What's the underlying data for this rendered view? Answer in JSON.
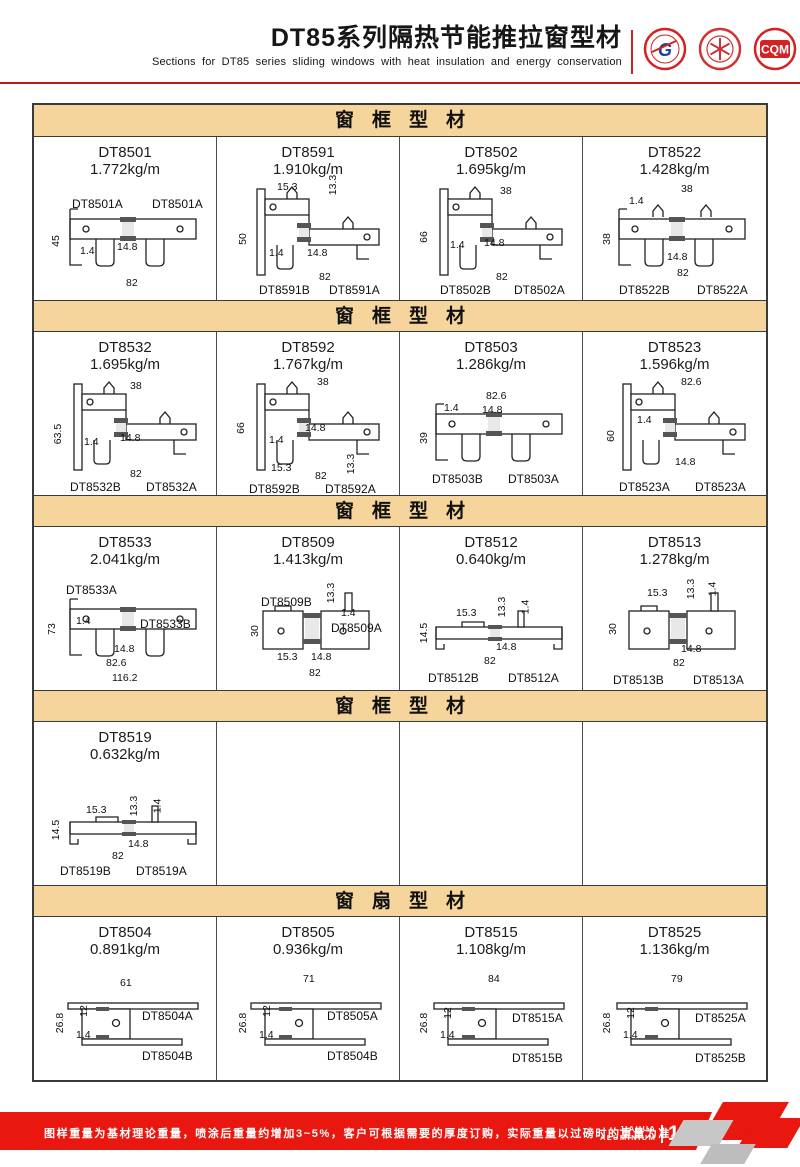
{
  "header": {
    "title": "DT85系列隔热节能推拉窗型材",
    "subtitle": "Sections for DT85 series sliding windows with heat insulation and energy conservation",
    "cqm": "CQM"
  },
  "colors": {
    "accent_red": "#e8170f",
    "rule_red": "#c51718",
    "band_tan": "#f5d59c",
    "line_dark": "#3a3a3a"
  },
  "sections": [
    {
      "title": "窗框型材",
      "cells": [
        {
          "code": "DT8501",
          "weight": "1.772kg/m",
          "shape": "flat",
          "labels": [
            {
              "t": "DT8501A",
              "x": 38,
              "y": 60
            },
            {
              "t": "DT8501A",
              "x": 118,
              "y": 60
            }
          ],
          "dims": [
            {
              "t": "45",
              "x": 16,
              "y": 98,
              "v": true
            },
            {
              "t": "1.4",
              "x": 46,
              "y": 108
            },
            {
              "t": "14.8",
              "x": 83,
              "y": 104
            },
            {
              "t": "82",
              "x": 92,
              "y": 140
            }
          ]
        },
        {
          "code": "DT8591",
          "weight": "1.910kg/m",
          "shape": "step",
          "labels": [
            {
              "t": "DT8591B",
              "x": 42,
              "y": 146
            },
            {
              "t": "DT8591A",
              "x": 112,
              "y": 146
            }
          ],
          "dims": [
            {
              "t": "15.3",
              "x": 60,
              "y": 44
            },
            {
              "t": "13.3",
              "x": 106,
              "y": 42,
              "v": true
            },
            {
              "t": "50",
              "x": 20,
              "y": 96,
              "v": true
            },
            {
              "t": "1.4",
              "x": 52,
              "y": 110
            },
            {
              "t": "14.8",
              "x": 90,
              "y": 110
            },
            {
              "t": "82",
              "x": 102,
              "y": 134
            }
          ]
        },
        {
          "code": "DT8502",
          "weight": "1.695kg/m",
          "shape": "step",
          "labels": [
            {
              "t": "DT8502B",
              "x": 40,
              "y": 146
            },
            {
              "t": "DT8502A",
              "x": 114,
              "y": 146
            }
          ],
          "dims": [
            {
              "t": "38",
              "x": 100,
              "y": 48
            },
            {
              "t": "66",
              "x": 18,
              "y": 94,
              "v": true
            },
            {
              "t": "1.4",
              "x": 50,
              "y": 102
            },
            {
              "t": "14.8",
              "x": 84,
              "y": 100
            },
            {
              "t": "82",
              "x": 96,
              "y": 134
            }
          ]
        },
        {
          "code": "DT8522",
          "weight": "1.428kg/m",
          "shape": "flatHooks",
          "labels": [
            {
              "t": "DT8522B",
              "x": 36,
              "y": 146
            },
            {
              "t": "DT8522A",
              "x": 114,
              "y": 146
            }
          ],
          "dims": [
            {
              "t": "38",
              "x": 98,
              "y": 46
            },
            {
              "t": "1.4",
              "x": 46,
              "y": 58
            },
            {
              "t": "38",
              "x": 18,
              "y": 96,
              "v": true
            },
            {
              "t": "14.8",
              "x": 84,
              "y": 114
            },
            {
              "t": "82",
              "x": 94,
              "y": 130
            }
          ]
        }
      ]
    },
    {
      "title": "窗框型材",
      "cells": [
        {
          "code": "DT8532",
          "weight": "1.695kg/m",
          "shape": "step",
          "labels": [
            {
              "t": "DT8532B",
              "x": 36,
              "y": 148
            },
            {
              "t": "DT8532A",
              "x": 112,
              "y": 148
            }
          ],
          "dims": [
            {
              "t": "38",
              "x": 96,
              "y": 48
            },
            {
              "t": "63.5",
              "x": 14,
              "y": 96,
              "v": true
            },
            {
              "t": "1.4",
              "x": 50,
              "y": 104
            },
            {
              "t": "14.8",
              "x": 86,
              "y": 100
            },
            {
              "t": "82",
              "x": 96,
              "y": 136
            }
          ]
        },
        {
          "code": "DT8592",
          "weight": "1.767kg/m",
          "shape": "step",
          "labels": [
            {
              "t": "DT8592B",
              "x": 32,
              "y": 150
            },
            {
              "t": "DT8592A",
              "x": 108,
              "y": 150
            }
          ],
          "dims": [
            {
              "t": "38",
              "x": 100,
              "y": 44
            },
            {
              "t": "66",
              "x": 18,
              "y": 90,
              "v": true
            },
            {
              "t": "1.4",
              "x": 52,
              "y": 102
            },
            {
              "t": "14.8",
              "x": 88,
              "y": 90
            },
            {
              "t": "15.3",
              "x": 54,
              "y": 130
            },
            {
              "t": "82",
              "x": 98,
              "y": 138
            },
            {
              "t": "13.3",
              "x": 124,
              "y": 126,
              "v": true
            }
          ]
        },
        {
          "code": "DT8503",
          "weight": "1.286kg/m",
          "shape": "flat",
          "labels": [
            {
              "t": "DT8503B",
              "x": 32,
              "y": 140
            },
            {
              "t": "DT8503A",
              "x": 108,
              "y": 140
            }
          ],
          "dims": [
            {
              "t": "82.6",
              "x": 86,
              "y": 58
            },
            {
              "t": "1.4",
              "x": 44,
              "y": 70
            },
            {
              "t": "14.8",
              "x": 82,
              "y": 72
            },
            {
              "t": "39",
              "x": 18,
              "y": 100,
              "v": true
            }
          ]
        },
        {
          "code": "DT8523",
          "weight": "1.596kg/m",
          "shape": "step",
          "labels": [
            {
              "t": "DT8523A",
              "x": 36,
              "y": 148
            },
            {
              "t": "DT8523A",
              "x": 112,
              "y": 148
            }
          ],
          "dims": [
            {
              "t": "82.6",
              "x": 98,
              "y": 44
            },
            {
              "t": "1.4",
              "x": 54,
              "y": 82
            },
            {
              "t": "60",
              "x": 22,
              "y": 98,
              "v": true
            },
            {
              "t": "14.8",
              "x": 92,
              "y": 124
            }
          ]
        }
      ]
    },
    {
      "title": "窗框型材",
      "cells": [
        {
          "code": "DT8533",
          "weight": "2.041kg/m",
          "shape": "flat",
          "labels": [
            {
              "t": "DT8533A",
              "x": 32,
              "y": 56
            },
            {
              "t": "DT8533B",
              "x": 106,
              "y": 90
            }
          ],
          "dims": [
            {
              "t": "73",
              "x": 12,
              "y": 96,
              "v": true
            },
            {
              "t": "1.4",
              "x": 42,
              "y": 88
            },
            {
              "t": "14.8",
              "x": 80,
              "y": 116
            },
            {
              "t": "82.6",
              "x": 72,
              "y": 130
            },
            {
              "t": "116.2",
              "x": 78,
              "y": 145
            }
          ]
        },
        {
          "code": "DT8509",
          "weight": "1.413kg/m",
          "shape": "mid",
          "labels": [
            {
              "t": "DT8509B",
              "x": 44,
              "y": 68
            },
            {
              "t": "DT8509A",
              "x": 114,
              "y": 94
            }
          ],
          "dims": [
            {
              "t": "13.3",
              "x": 104,
              "y": 60,
              "v": true
            },
            {
              "t": "30",
              "x": 32,
              "y": 98,
              "v": true
            },
            {
              "t": "1.4",
              "x": 124,
              "y": 80
            },
            {
              "t": "15.3",
              "x": 60,
              "y": 124
            },
            {
              "t": "14.8",
              "x": 94,
              "y": 124
            },
            {
              "t": "82",
              "x": 92,
              "y": 140
            }
          ]
        },
        {
          "code": "DT8512",
          "weight": "0.640kg/m",
          "shape": "low",
          "labels": [
            {
              "t": "DT8512B",
              "x": 28,
              "y": 144
            },
            {
              "t": "DT8512A",
              "x": 108,
              "y": 144
            }
          ],
          "dims": [
            {
              "t": "15.3",
              "x": 56,
              "y": 80
            },
            {
              "t": "13.3",
              "x": 92,
              "y": 74,
              "v": true
            },
            {
              "t": "1.4",
              "x": 118,
              "y": 74,
              "v": true
            },
            {
              "t": "14.5",
              "x": 14,
              "y": 100,
              "v": true
            },
            {
              "t": "14.8",
              "x": 96,
              "y": 114
            },
            {
              "t": "82",
              "x": 84,
              "y": 128
            }
          ]
        },
        {
          "code": "DT8513",
          "weight": "1.278kg/m",
          "shape": "mid",
          "labels": [
            {
              "t": "DT8513B",
              "x": 30,
              "y": 146
            },
            {
              "t": "DT8513A",
              "x": 110,
              "y": 146
            }
          ],
          "dims": [
            {
              "t": "15.3",
              "x": 64,
              "y": 60
            },
            {
              "t": "13.3",
              "x": 98,
              "y": 56,
              "v": true
            },
            {
              "t": "1.4",
              "x": 122,
              "y": 56,
              "v": true
            },
            {
              "t": "30",
              "x": 24,
              "y": 96,
              "v": true
            },
            {
              "t": "14.8",
              "x": 98,
              "y": 116
            },
            {
              "t": "82",
              "x": 90,
              "y": 130
            }
          ]
        }
      ]
    },
    {
      "title": "窗框型材",
      "cells": [
        {
          "code": "DT8519",
          "weight": "0.632kg/m",
          "shape": "low",
          "labels": [
            {
              "t": "DT8519B",
              "x": 26,
              "y": 142
            },
            {
              "t": "DT8519A",
              "x": 102,
              "y": 142
            }
          ],
          "dims": [
            {
              "t": "15.3",
              "x": 52,
              "y": 82
            },
            {
              "t": "13.3",
              "x": 90,
              "y": 78,
              "v": true
            },
            {
              "t": "1.4",
              "x": 116,
              "y": 78,
              "v": true
            },
            {
              "t": "14.5",
              "x": 12,
              "y": 102,
              "v": true
            },
            {
              "t": "14.8",
              "x": 94,
              "y": 116
            },
            {
              "t": "82",
              "x": 78,
              "y": 128
            }
          ]
        },
        null,
        null,
        null
      ]
    },
    {
      "title": "窗扇型材",
      "cells": [
        {
          "code": "DT8504",
          "weight": "0.891kg/m",
          "shape": "sash",
          "labels": [
            {
              "t": "DT8504A",
              "x": 108,
              "y": 92
            },
            {
              "t": "DT8504B",
              "x": 108,
              "y": 132
            }
          ],
          "dims": [
            {
              "t": "61",
              "x": 86,
              "y": 60
            },
            {
              "t": "12",
              "x": 44,
              "y": 88,
              "v": true
            },
            {
              "t": "26.8",
              "x": 16,
              "y": 100,
              "v": true
            },
            {
              "t": "1.4",
              "x": 42,
              "y": 112
            }
          ]
        },
        {
          "code": "DT8505",
          "weight": "0.936kg/m",
          "shape": "sash",
          "labels": [
            {
              "t": "DT8505A",
              "x": 110,
              "y": 92
            },
            {
              "t": "DT8504B",
              "x": 110,
              "y": 132
            }
          ],
          "dims": [
            {
              "t": "71",
              "x": 86,
              "y": 56
            },
            {
              "t": "12",
              "x": 44,
              "y": 88,
              "v": true
            },
            {
              "t": "26.8",
              "x": 16,
              "y": 100,
              "v": true
            },
            {
              "t": "1.4",
              "x": 42,
              "y": 112
            }
          ]
        },
        {
          "code": "DT8515",
          "weight": "1.108kg/m",
          "shape": "sash",
          "labels": [
            {
              "t": "DT8515A",
              "x": 112,
              "y": 94
            },
            {
              "t": "DT8515B",
              "x": 112,
              "y": 134
            }
          ],
          "dims": [
            {
              "t": "84",
              "x": 88,
              "y": 56
            },
            {
              "t": "12",
              "x": 42,
              "y": 90,
              "v": true
            },
            {
              "t": "26.8",
              "x": 14,
              "y": 100,
              "v": true
            },
            {
              "t": "1.4",
              "x": 40,
              "y": 112
            }
          ]
        },
        {
          "code": "DT8525",
          "weight": "1.136kg/m",
          "shape": "sash",
          "labels": [
            {
              "t": "DT8525A",
              "x": 112,
              "y": 94
            },
            {
              "t": "DT8525B",
              "x": 112,
              "y": 134
            }
          ],
          "dims": [
            {
              "t": "79",
              "x": 88,
              "y": 56
            },
            {
              "t": "12",
              "x": 42,
              "y": 90,
              "v": true
            },
            {
              "t": "26.8",
              "x": 14,
              "y": 100,
              "v": true
            },
            {
              "t": "1.4",
              "x": 40,
              "y": 112
            }
          ]
        }
      ]
    }
  ],
  "footer": {
    "note": "图样重量为基材理论重量，喷涂后重量约增加3~5%，客户可根据需要的厚度订购，实际重量以过磅时的重量为准。",
    "brand_line1": "JIAHUA",
    "brand_line2": "ALUMINIUM",
    "page": "155"
  }
}
